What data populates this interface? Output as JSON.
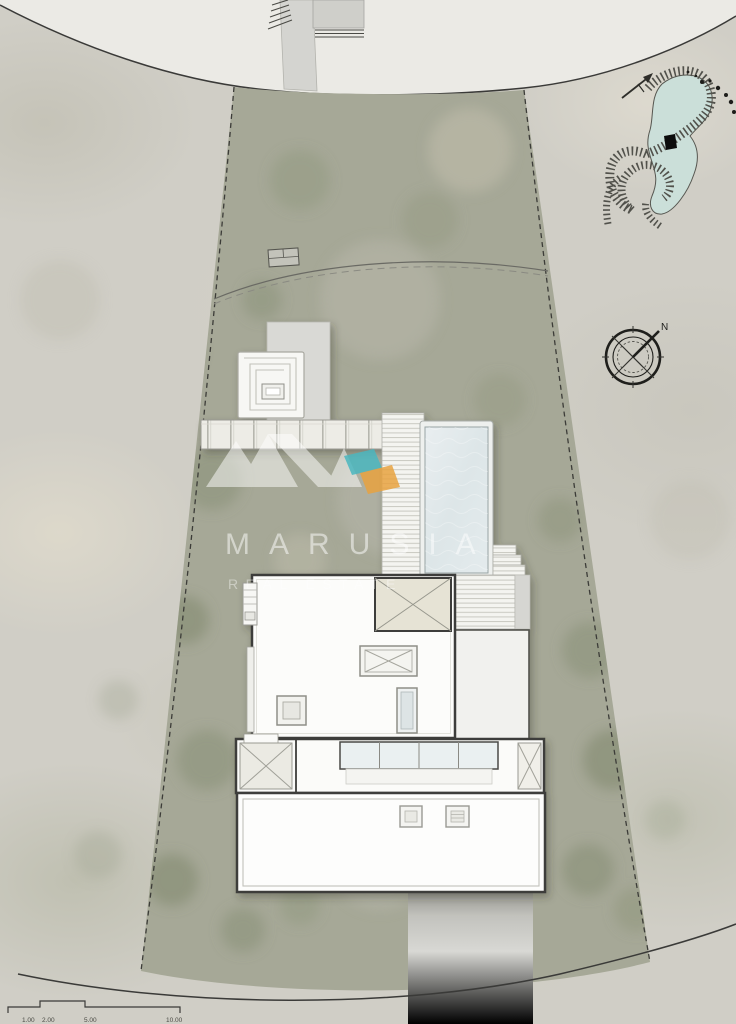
{
  "meta": {
    "drawing_type": "architectural roof / site plan",
    "description": "Villa roof plan on trapezoidal plot between two curved roads"
  },
  "watermark": {
    "brand": "MARUSIA",
    "tagline": "REAL ESTATE",
    "accent_teal": "#4ab6be",
    "accent_orange": "#e8a23f"
  },
  "compass": {
    "north_label": "N"
  },
  "key_map": {
    "marker_color": "#0c0c0c",
    "water_color": "#cbdfd9"
  },
  "scale_bar": {
    "labels": [
      "1.00",
      "2.00",
      "5.00",
      "10.00"
    ]
  },
  "colors": {
    "terrain": "#d0cec6",
    "road": "#ebeae5",
    "plot_green": "#a6a897",
    "roof_white": "#fcfcfa",
    "skylight_beige": "#e6e3d5",
    "pool_water": "#dde6e8",
    "outline_dark": "#3e3e3a"
  }
}
